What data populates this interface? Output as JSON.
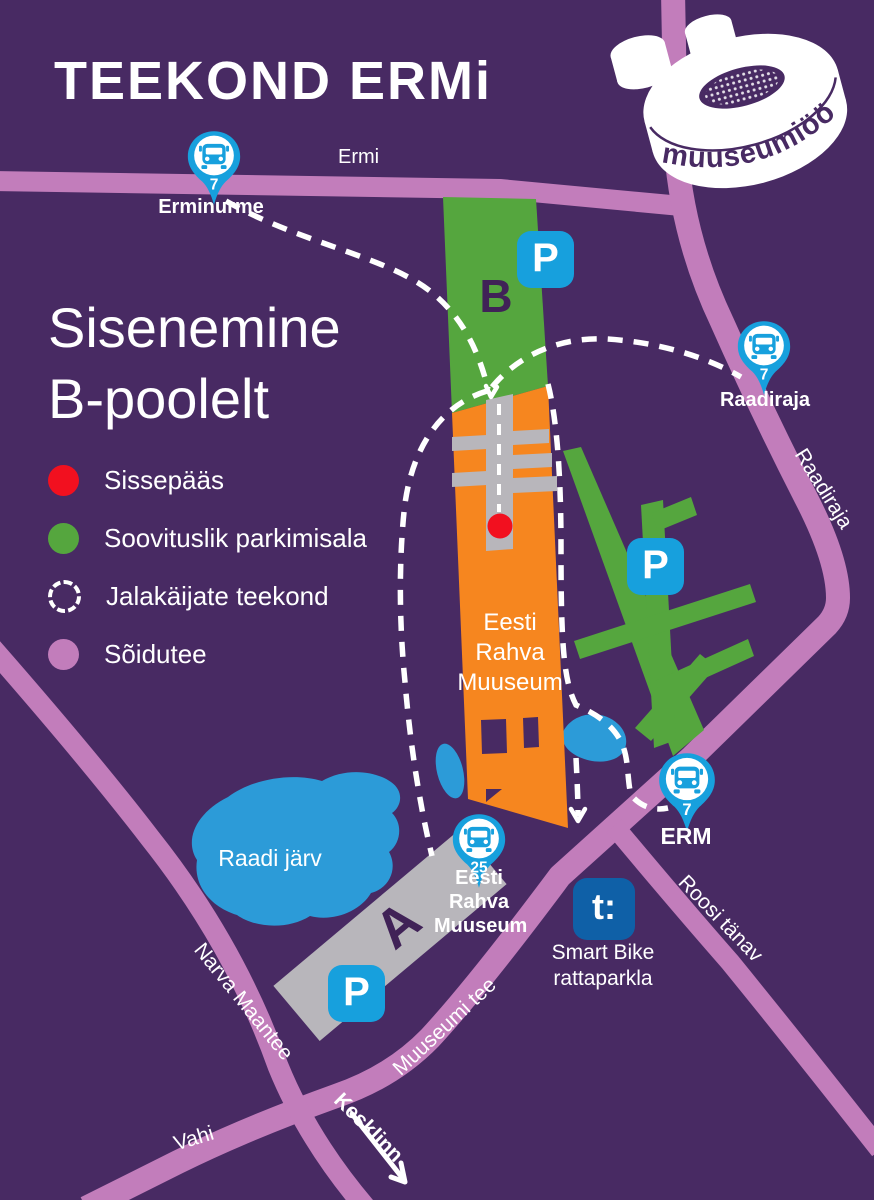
{
  "title": "TEEKOND ERMi",
  "subtitle": "Sisenemine\nB-poolelt",
  "subtitle_line1": "Sisenemine",
  "subtitle_line2": "B-poolelt",
  "logo": {
    "text": "muuseumiöö"
  },
  "legend": {
    "entrance": "Sissepääs",
    "parking": "Soovituslik parkimisala",
    "walkway": "Jalakäijate teekond",
    "roadway": "Sõidutee"
  },
  "labels": {
    "ermi_road": "Ermi",
    "raadiraja_road": "Raadiraja",
    "raadi_lake": "Raadi järv",
    "narva_road": "Narva Maantee",
    "muuseumi_road": "Muuseumi tee",
    "vahi_road": "Vahi",
    "roosi_road": "Roosi tänav",
    "kesklinn": "Kesklinn",
    "zone_b": "B",
    "zone_a": "A",
    "parking_p": "P",
    "museum_building": "Eesti Rahva Muuseum"
  },
  "stops": [
    {
      "name": "Erminurme",
      "line": "7"
    },
    {
      "name": "Raadiraja",
      "line": "7"
    },
    {
      "name": "ERM",
      "line": "7"
    },
    {
      "name": "Eesti Rahva Muuseum",
      "line": "25"
    }
  ],
  "smart_bike": {
    "logo_text": "t:",
    "label": "Smart Bike rattaparkla"
  },
  "colors": {
    "bg": "#482a63",
    "road": "#c27dbb",
    "green": "#55a63e",
    "orange": "#f6861f",
    "gray": "#b8b6bb",
    "water": "#2c9bd8",
    "pinblue": "#17a0dd",
    "bike": "#0f60a7",
    "red": "#f2101f",
    "letter": "#402257"
  }
}
